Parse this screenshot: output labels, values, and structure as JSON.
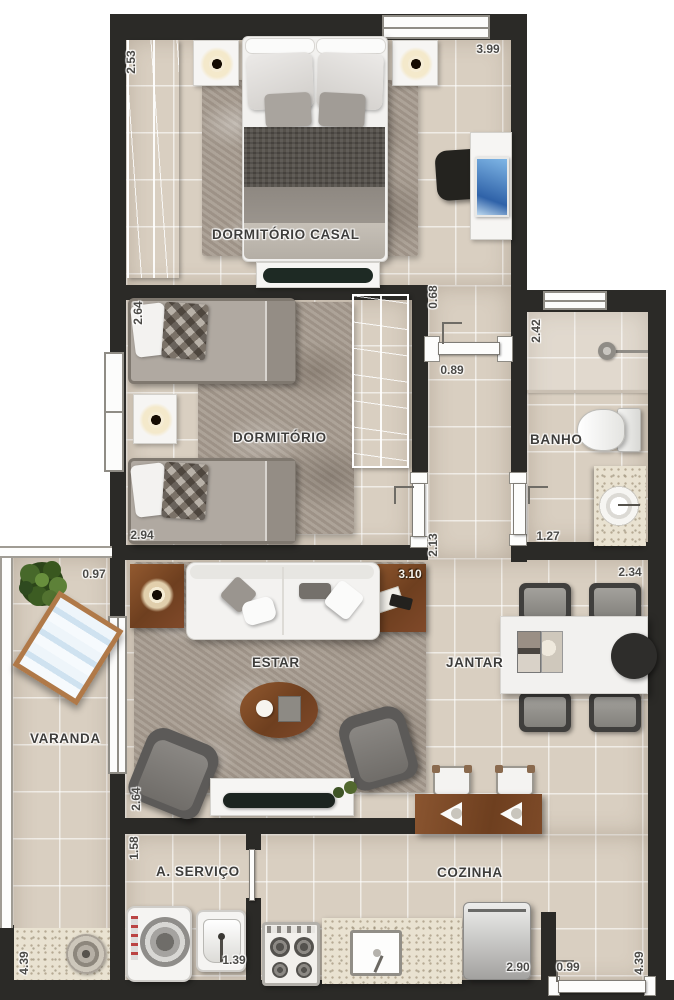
{
  "plan": {
    "type": "apartment-floor-plan",
    "labels": {
      "dormitorio_casal": "DORMITÓRIO CASAL",
      "dormitorio": "DORMITÓRIO",
      "banho": "BANHO",
      "estar": "ESTAR",
      "jantar": "JANTAR",
      "varanda": "VARANDA",
      "servico": "A. SERVIÇO",
      "cozinha": "COZINHA"
    },
    "dims": {
      "casal_top": "3.99",
      "casal_left": "2.53",
      "hall_top": "0.68",
      "hall_door": "0.89",
      "hall_bottom": "2.13",
      "dorm_top": "2.64",
      "dorm_bottom": "2.94",
      "banho_side": "2.42",
      "banho_bottom": "1.27",
      "varanda_top": "0.97",
      "varanda_side": "4.39",
      "estar_table": "3.10",
      "estar_side": "2.64",
      "jantar_top": "2.34",
      "servico_side": "1.58",
      "servico_tank": "1.39",
      "cozinha_bottom": "2.90",
      "entry": "0.99",
      "cozinha_side": "4.39"
    },
    "colors": {
      "wall": "#2b2a27",
      "floor_tile": "#d9cfc1",
      "granite": "#e9e2d1",
      "wood_light": "#d5bc8d",
      "wood_dark": "#7c4a27",
      "rug": "#a79c90",
      "label_text": "#3e3d3b"
    }
  }
}
